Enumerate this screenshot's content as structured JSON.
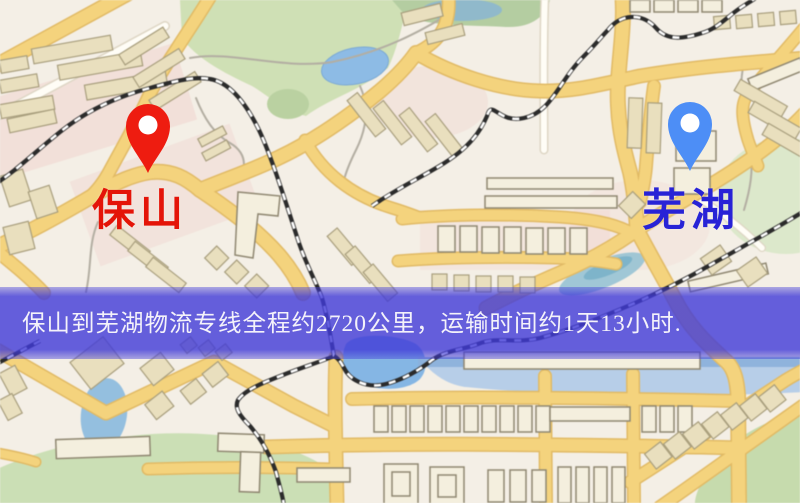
{
  "place_markers": {
    "origin": {
      "label": "保山",
      "pin_color": "#ee1c10",
      "label_color": "#e41408"
    },
    "destination": {
      "label": "芜湖",
      "pin_color": "#4d8ef6",
      "label_color": "#2823d6"
    }
  },
  "banner": {
    "text": "保山到芜湖物流专线全程约2720公里，运输时间约1天13小时.",
    "background_color": "#403ad8",
    "text_color": "#f4f2fa"
  },
  "map_palette": {
    "background": "#f4efe6",
    "road_major": "#f5d37a",
    "road_casing": "#e2ba62",
    "park_green": "#cfe0b4",
    "water_blue": "#8cbbe6",
    "building_tan": "#e9dfbd",
    "railway_dark": "#2b2b2b"
  }
}
